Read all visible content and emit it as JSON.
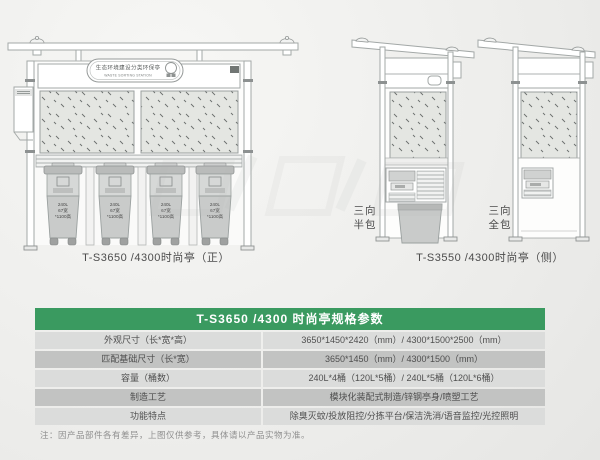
{
  "front_view": {
    "sign": {
      "cn": "生态环境建设分类环保亭",
      "en": "WASTE SORTING STATION"
    },
    "bin_label": {
      "l1": "240L",
      "l2": "67宽",
      "l3": "*1100高"
    },
    "caption": "T-S3650 /4300时尚亭（正）"
  },
  "side_view": {
    "half_wrap": {
      "line1": "三向",
      "line2": "半包"
    },
    "full_wrap": {
      "line1": "三向",
      "line2": "全包"
    },
    "caption": "T-S3550 /4300时尚亭（侧）"
  },
  "spec_table": {
    "title": "T-S3650 /4300 时尚亭规格参数",
    "header_bg": "#3a9a60",
    "rows": [
      {
        "label": "外观尺寸（长*宽*高）",
        "value": "3650*1450*2420（mm）/ 4300*1500*2500（mm）"
      },
      {
        "label": "匹配基础尺寸（长*宽）",
        "value": "3650*1450（mm）/ 4300*1500（mm）"
      },
      {
        "label": "容量（桶数）",
        "value": "240L*4桶（120L*5桶）/ 240L*5桶（120L*6桶）"
      },
      {
        "label": "制造工艺",
        "value": "模块化装配式制造/锌钢亭身/喷塑工艺"
      },
      {
        "label": "功能特点",
        "value": "除臭灭蚊/投放阻控/分拣平台/保洁洗消/语音监控/光控照明"
      }
    ],
    "footnote": "注：因产品部件各有差异，上图仅供参考，具体请以产品实物为准。"
  }
}
